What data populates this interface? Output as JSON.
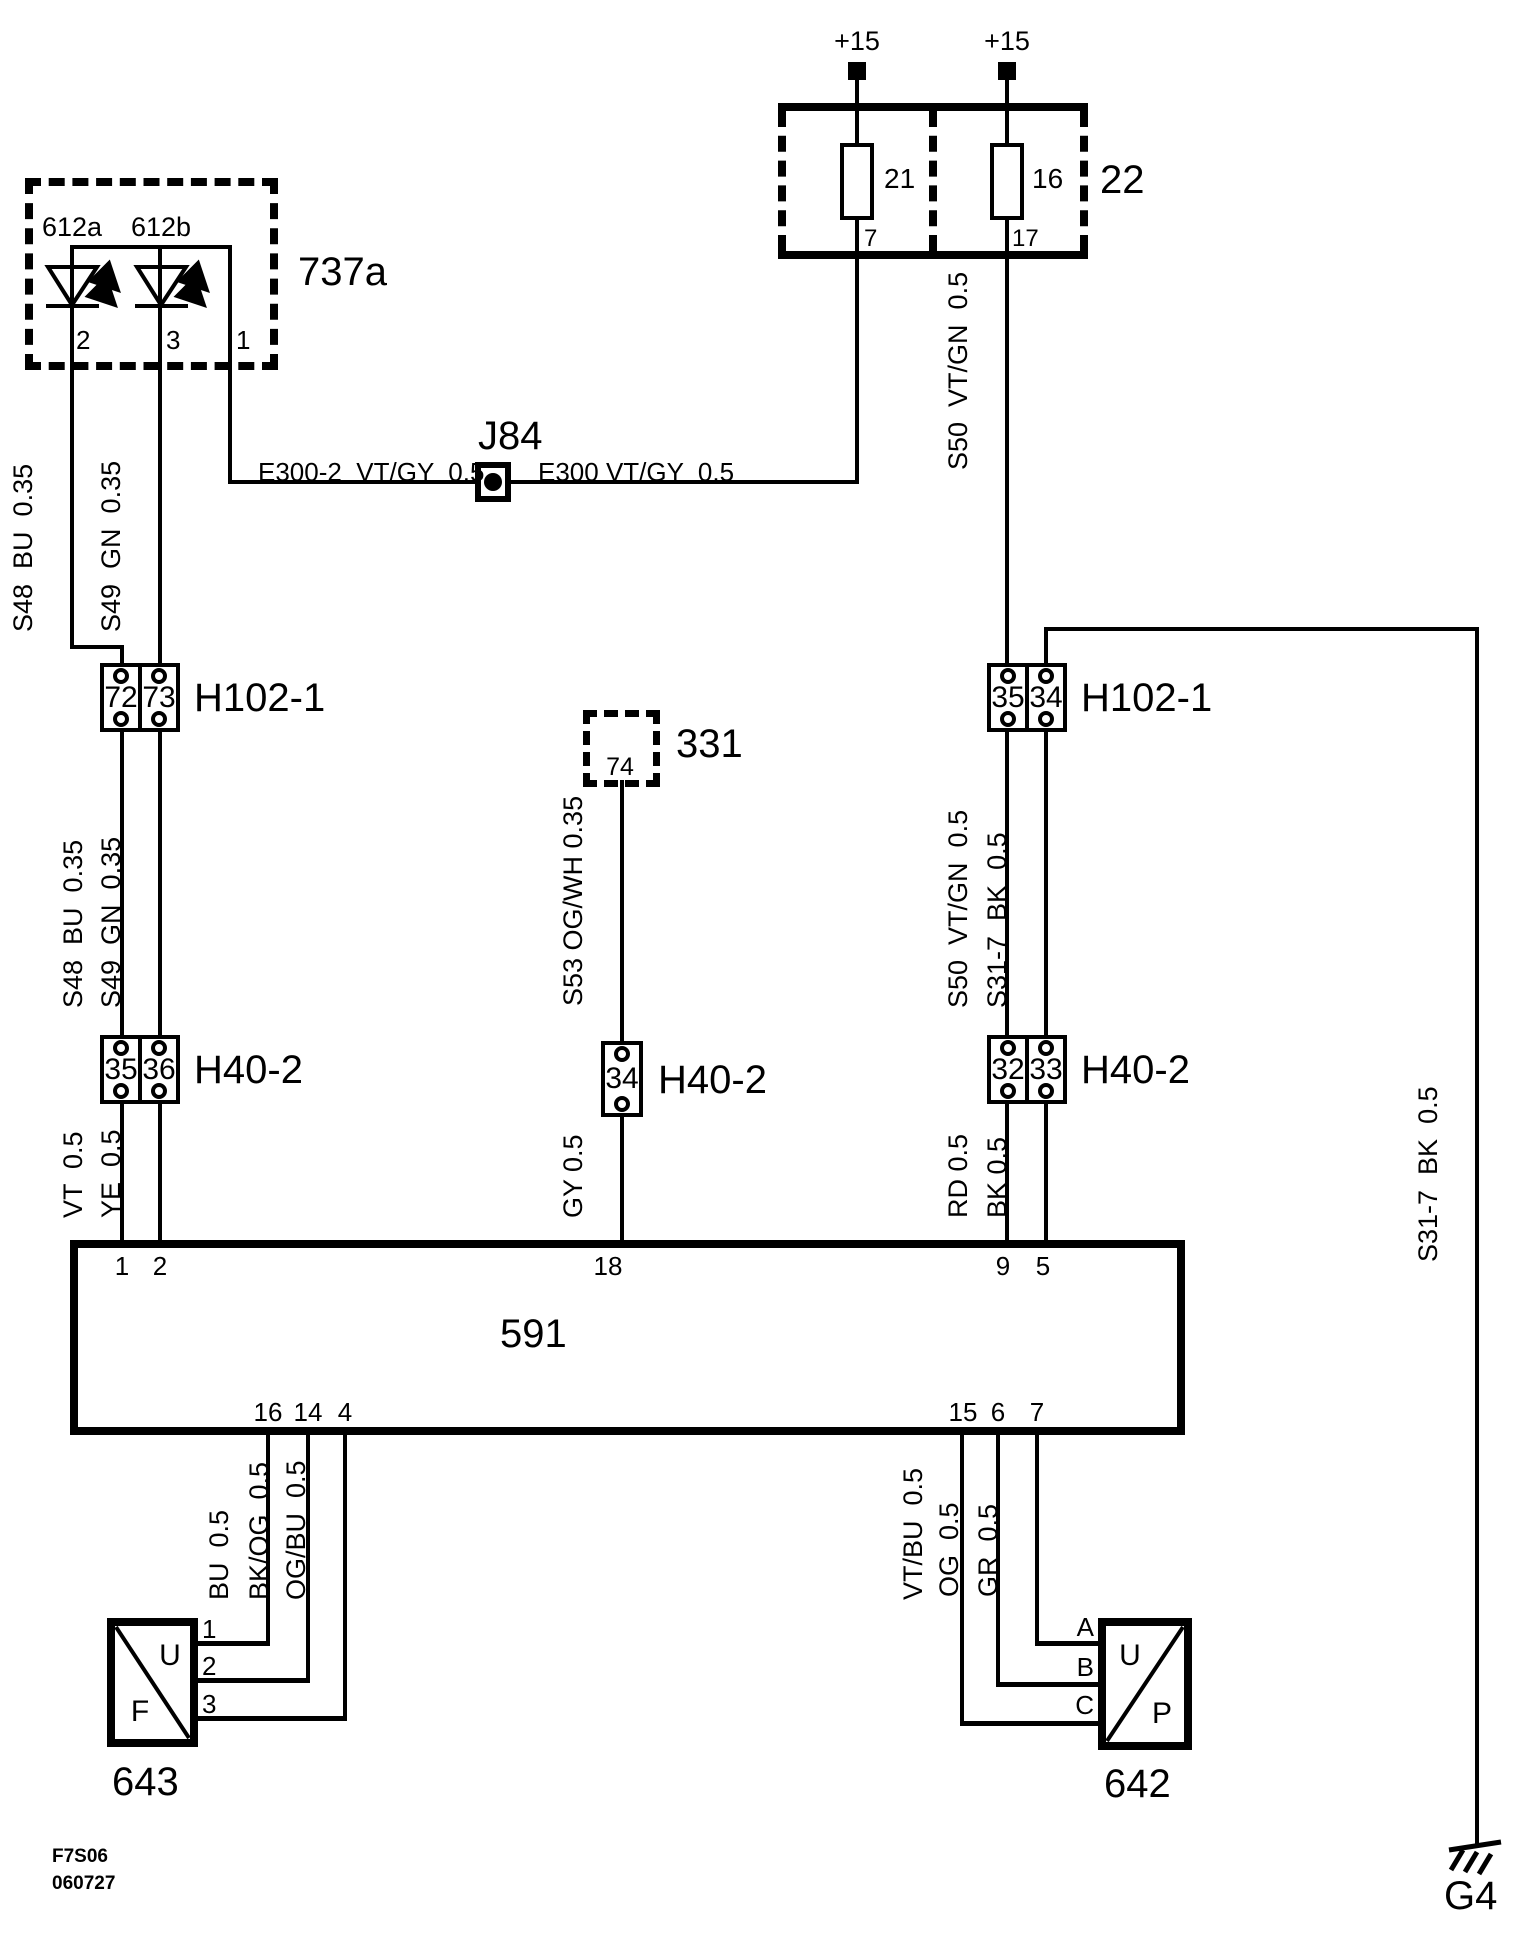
{
  "supply": {
    "left": "+15",
    "right": "+15"
  },
  "fusebox": {
    "label": "22",
    "fuse_left": {
      "num": "21",
      "pin": "7"
    },
    "fuse_right": {
      "num": "16",
      "pin": "17"
    }
  },
  "lamp_unit": {
    "label": "737a",
    "led_left": "612a",
    "led_right": "612b",
    "pin_left": "2",
    "pin_mid": "3",
    "pin_right": "1"
  },
  "junction": {
    "label": "J84",
    "wire_left": "E300-2  VT/GY  0.5",
    "wire_right": "E300 VT/GY  0.5"
  },
  "connectors": {
    "h102_left": {
      "label": "H102-1",
      "pin_a": "72",
      "pin_b": "73"
    },
    "h102_right": {
      "label": "H102-1",
      "pin_a": "35",
      "pin_b": "34"
    },
    "h40_left": {
      "label": "H40-2",
      "pin_a": "35",
      "pin_b": "36"
    },
    "h40_mid": {
      "label": "H40-2",
      "pin_a": "34"
    },
    "h40_right": {
      "label": "H40-2",
      "pin_a": "32",
      "pin_b": "33"
    }
  },
  "box331": {
    "label": "331",
    "pin": "74"
  },
  "wire_labels": {
    "s48_upper": "S48  BU  0.35",
    "s49_upper": "S49  GN  0.35",
    "s50_upper": "S50  VT/GN  0.5",
    "s48_lower": "S48  BU  0.35",
    "s49_lower": "S49  GN  0.35",
    "s53": "S53 OG/WH 0.35",
    "s50_lower": "S50  VT/GN  0.5",
    "s31_mid": "S31-7  BK  0.5",
    "s31_right": "S31-7  BK  0.5",
    "vt": "VT  0.5",
    "ye": "YE  0.5",
    "gy": "GY 0.5",
    "rd": "RD 0.5",
    "bk": "BK 0.5",
    "bu": "BU  0.5",
    "bkog": "BK/OG  0.5",
    "ogbu": "OG/BU  0.5",
    "vtbu": "VT/BU  0.5",
    "og": "OG  0.5",
    "gr": "GR  0.5"
  },
  "ecu": {
    "label": "591",
    "pin_1": "1",
    "pin_2": "2",
    "pin_18": "18",
    "pin_9": "9",
    "pin_5": "5",
    "pin_16": "16",
    "pin_14": "14",
    "pin_4": "4",
    "pin_15": "15",
    "pin_6": "6",
    "pin_7": "7"
  },
  "comp_left": {
    "label": "643",
    "letter_top": "U",
    "letter_bottom": "F",
    "pin_a": "1",
    "pin_b": "2",
    "pin_c": "3"
  },
  "comp_right": {
    "label": "642",
    "letter_top": "U",
    "letter_bottom": "P",
    "pin_a": "A",
    "pin_b": "B",
    "pin_c": "C"
  },
  "ground": {
    "label": "G4"
  },
  "footer": {
    "code": "F7S06",
    "date": "060727"
  }
}
